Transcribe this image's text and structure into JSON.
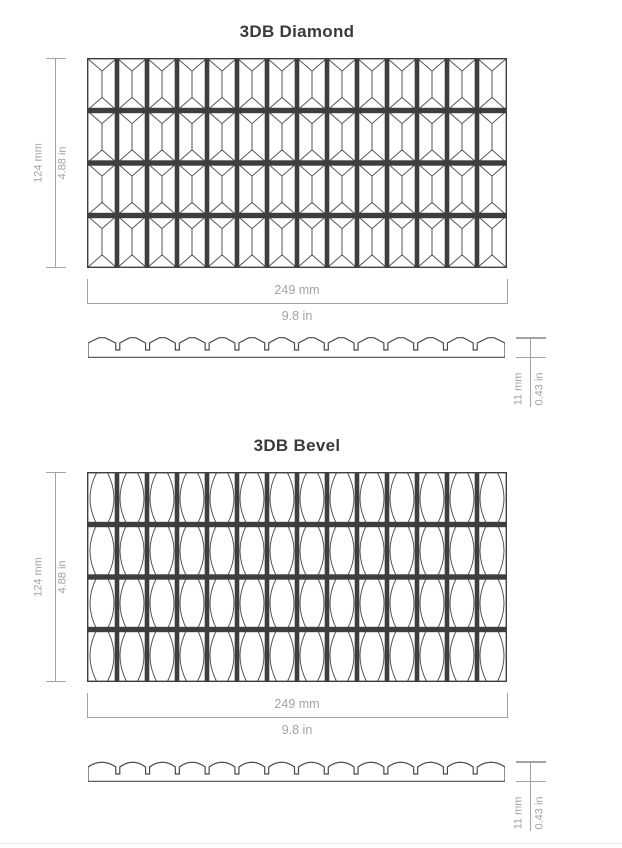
{
  "colors": {
    "dark": "#3e3e3e",
    "facet_line": "#555555",
    "profile_line": "#4a4a4a",
    "dimension": "#a3a3a3",
    "title": "#3a3a3a"
  },
  "sections": [
    {
      "title": "3DB Diamond",
      "pattern": "diamond",
      "grid": {
        "rows": 4,
        "columns": 14
      },
      "dimensions": {
        "height_mm": "124 mm",
        "height_in": "4.88 in",
        "width_mm": "249 mm",
        "width_in": "9.8 in",
        "thickness_mm": "11 mm",
        "thickness_in": "0.43 in"
      }
    },
    {
      "title": "3DB Bevel",
      "pattern": "bevel",
      "grid": {
        "rows": 4,
        "columns": 14
      },
      "dimensions": {
        "height_mm": "124 mm",
        "height_in": "4.88 in",
        "width_mm": "249 mm",
        "width_in": "9.8 in",
        "thickness_mm": "11 mm",
        "thickness_in": "0.43 in"
      }
    }
  ]
}
